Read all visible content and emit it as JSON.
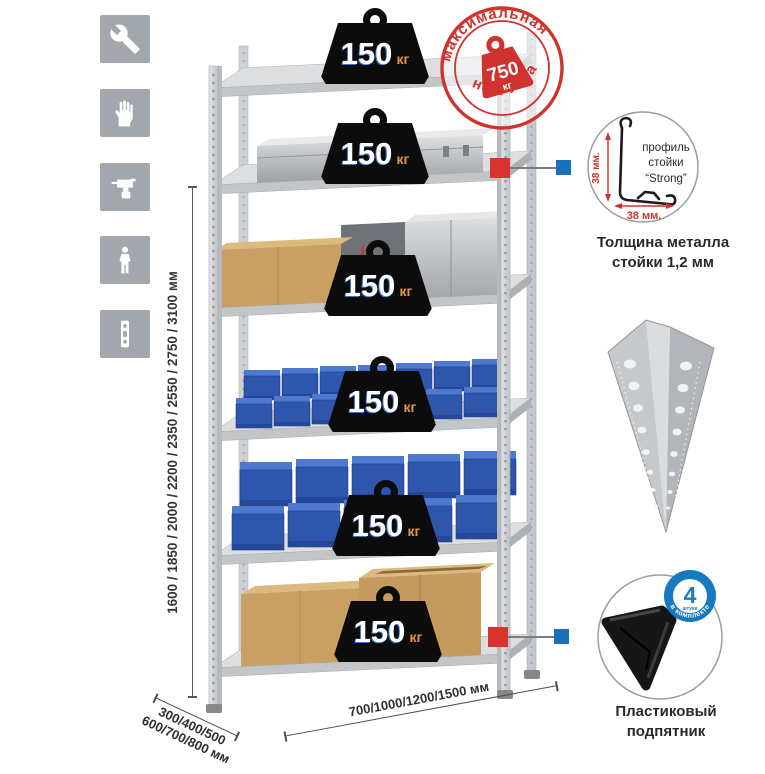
{
  "colors": {
    "accent_red": "#d8342f",
    "accent_blue": "#1a70bd",
    "bin_blue": "#2d56ac",
    "icon_gray": "#a2a7ad",
    "metal_gray": "#d5d7d9",
    "text_dark": "#2f2f31"
  },
  "left_icons": [
    {
      "name": "wrench-icon"
    },
    {
      "name": "gloves-icon"
    },
    {
      "name": "drill-icon"
    },
    {
      "name": "person-icon"
    },
    {
      "name": "level-icon"
    }
  ],
  "dimensions": {
    "height": {
      "label": "1600 / 1850 / 2000 / 2200 / 2350 / 2550 / 2750 / 3100 мм"
    },
    "depth": {
      "line1": "300/400/500",
      "line2": "600/700/800 мм"
    },
    "width": {
      "label": "700/1000/1200/1500 мм"
    }
  },
  "shelf_load": {
    "value": "150",
    "unit": "кг"
  },
  "stamp": {
    "arc_top": "максимальная",
    "arc_bottom": "нагрузка",
    "value": "750",
    "unit": "кг"
  },
  "profile_detail": {
    "text_line1": "профиль",
    "text_line2": "стойки",
    "text_line3": "“Strong”",
    "dim_vertical": "38 мм.",
    "dim_horizontal": "38 мм.",
    "caption_line1": "Толщина металла",
    "caption_line2": "стойки 1,2 мм"
  },
  "foot_detail": {
    "badge_number": "4",
    "badge_sub": "штуки",
    "badge_arc": "в комплекте",
    "caption_line1": "Пластиковый",
    "caption_line2": "подпятник"
  }
}
